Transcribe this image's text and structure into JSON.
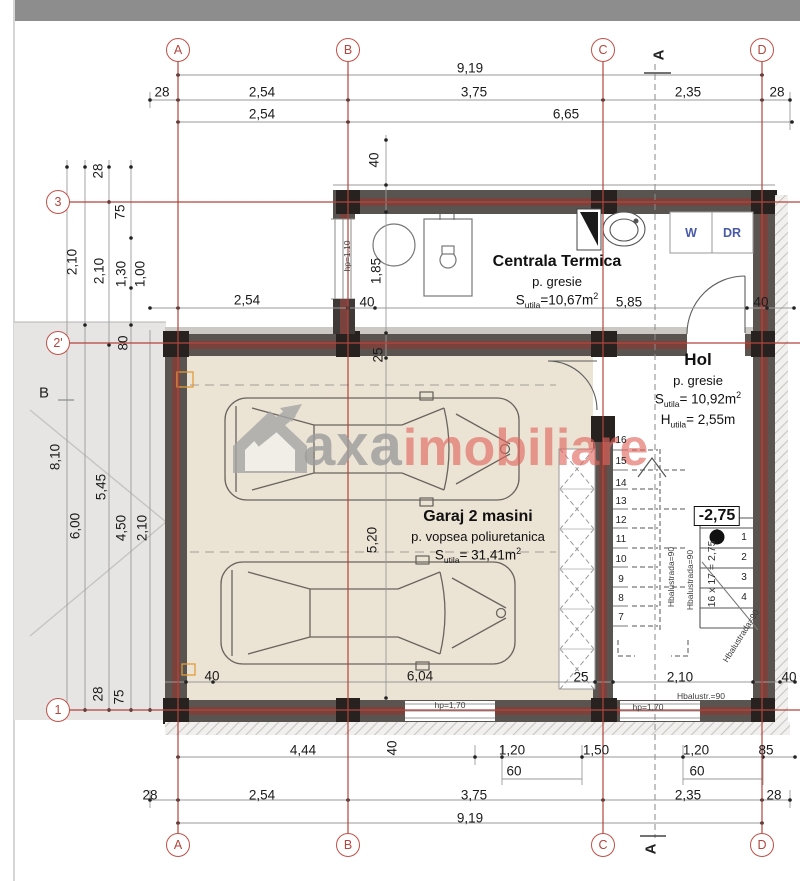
{
  "colors": {
    "axis_red": "#b2453c",
    "wall_gray": "#595450",
    "wall_core_red": "#7a423c",
    "column_black": "#272220",
    "garage_floor_beige": "#ebe3d4",
    "neighbor_gray": "#e6e5e4",
    "watermark_gray": "#9c9c9c",
    "watermark_red": "#e2645c",
    "wdr_blue": "#4a5aa8",
    "marker_orange": "#e09a3a"
  },
  "watermark": {
    "word1": "axa",
    "word2": "imobiliare"
  },
  "rooms": {
    "centrala": {
      "name": "Centrala Termica",
      "finish": "p. gresie",
      "area_label": "S",
      "area_sub": "utila",
      "area_val": "=10,67m",
      "area_sup": "2"
    },
    "hol": {
      "name": "Hol",
      "finish": "p. gresie",
      "area_label": "S",
      "area_sub": "utila",
      "area_val": "= 10,92m",
      "area_sup": "2",
      "height_label": "H",
      "height_sub": "utila",
      "height_val": "= 2,55m"
    },
    "garaj": {
      "name": "Garaj 2 masini",
      "finish": "p. vopsea poliuretanica",
      "area_label": "S",
      "area_sub": "utila",
      "area_val": "= 31,41m",
      "area_sup": "2"
    }
  },
  "labels": [
    {
      "t": "9,19",
      "x": 470,
      "y": 68
    },
    {
      "t": "28",
      "x": 162,
      "y": 92
    },
    {
      "t": "2,54",
      "x": 262,
      "y": 92
    },
    {
      "t": "3,75",
      "x": 474,
      "y": 92
    },
    {
      "t": "2,35",
      "x": 688,
      "y": 92
    },
    {
      "t": "28",
      "x": 777,
      "y": 92
    },
    {
      "t": "2,54",
      "x": 262,
      "y": 114
    },
    {
      "t": "6,65",
      "x": 566,
      "y": 114
    },
    {
      "t": "40",
      "x": 374,
      "y": 160,
      "r": -90
    },
    {
      "t": "28",
      "x": 98,
      "y": 171,
      "r": -90
    },
    {
      "t": "75",
      "x": 120,
      "y": 212,
      "r": -90
    },
    {
      "t": "2,10",
      "x": 72,
      "y": 262,
      "r": -90
    },
    {
      "t": "2,10",
      "x": 99,
      "y": 271,
      "r": -90
    },
    {
      "t": "1,30",
      "x": 121,
      "y": 274,
      "r": -90
    },
    {
      "t": "1,00",
      "x": 140,
      "y": 274,
      "r": -90
    },
    {
      "t": "80",
      "x": 123,
      "y": 343,
      "r": -90
    },
    {
      "t": "2,54",
      "x": 247,
      "y": 300
    },
    {
      "t": "40",
      "x": 367,
      "y": 302
    },
    {
      "t": "1,85",
      "x": 376,
      "y": 271,
      "r": -90
    },
    {
      "t": "hp=1.10",
      "x": 347,
      "y": 256,
      "r": -90,
      "cls": "tiny"
    },
    {
      "t": "5,85",
      "x": 629,
      "y": 302
    },
    {
      "t": "40",
      "x": 761,
      "y": 302
    },
    {
      "t": "25",
      "x": 378,
      "y": 355,
      "r": -90
    },
    {
      "t": "8,10",
      "x": 55,
      "y": 457,
      "r": -90
    },
    {
      "t": "5,45",
      "x": 101,
      "y": 487,
      "r": -90
    },
    {
      "t": "6,00",
      "x": 75,
      "y": 526,
      "r": -90
    },
    {
      "t": "4,50",
      "x": 121,
      "y": 528,
      "r": -90
    },
    {
      "t": "2,10",
      "x": 142,
      "y": 528,
      "r": -90
    },
    {
      "t": "28",
      "x": 98,
      "y": 694,
      "r": -90
    },
    {
      "t": "75",
      "x": 119,
      "y": 697,
      "r": -90
    },
    {
      "t": "B",
      "x": 44,
      "y": 393,
      "cls": "big"
    },
    {
      "t": "5,20",
      "x": 372,
      "y": 540,
      "r": -90
    },
    {
      "t": "40",
      "x": 212,
      "y": 676
    },
    {
      "t": "6,04",
      "x": 420,
      "y": 676
    },
    {
      "t": "25",
      "x": 581,
      "y": 677
    },
    {
      "t": "2,10",
      "x": 680,
      "y": 677
    },
    {
      "t": "40",
      "x": 789,
      "y": 677
    },
    {
      "t": "4,44",
      "x": 303,
      "y": 750
    },
    {
      "t": "40",
      "x": 392,
      "y": 748,
      "r": -90
    },
    {
      "t": "1,20",
      "x": 512,
      "y": 750
    },
    {
      "t": "1,50",
      "x": 596,
      "y": 750
    },
    {
      "t": "1,20",
      "x": 696,
      "y": 750
    },
    {
      "t": "85",
      "x": 766,
      "y": 750
    },
    {
      "t": "60",
      "x": 514,
      "y": 771
    },
    {
      "t": "60",
      "x": 697,
      "y": 771
    },
    {
      "t": "28",
      "x": 150,
      "y": 795
    },
    {
      "t": "2,54",
      "x": 262,
      "y": 795
    },
    {
      "t": "3,75",
      "x": 474,
      "y": 795
    },
    {
      "t": "2,35",
      "x": 688,
      "y": 795
    },
    {
      "t": "28",
      "x": 774,
      "y": 795
    },
    {
      "t": "9,19",
      "x": 470,
      "y": 818
    },
    {
      "t": "hp=1,70",
      "x": 450,
      "y": 705,
      "cls": "tiny"
    },
    {
      "t": "hp=1,70",
      "x": 648,
      "y": 707,
      "cls": "tiny"
    },
    {
      "t": "Hbalustr.=90",
      "x": 701,
      "y": 696,
      "cls": "tiny"
    },
    {
      "t": "Hbalustrada=90",
      "x": 671,
      "y": 577,
      "r": -90,
      "cls": "tiny"
    },
    {
      "t": "Hbalustrada=90",
      "x": 690,
      "y": 580,
      "r": -90,
      "cls": "tiny"
    },
    {
      "t": "Hbalustrada=90",
      "x": 741,
      "y": 636,
      "r": -58,
      "cls": "tiny"
    },
    {
      "t": "16 x 17 = 2,75",
      "x": 712,
      "y": 574,
      "r": -90,
      "cls": "small"
    },
    {
      "t": "W",
      "x": 691,
      "y": 233,
      "cls": "wdr"
    },
    {
      "t": "DR",
      "x": 732,
      "y": 233,
      "cls": "wdr"
    },
    {
      "t": "16",
      "x": 621,
      "y": 441,
      "cls": "step"
    },
    {
      "t": "15",
      "x": 621,
      "y": 462,
      "cls": "step"
    },
    {
      "t": "14",
      "x": 621,
      "y": 484,
      "cls": "step"
    },
    {
      "t": "13",
      "x": 621,
      "y": 502,
      "cls": "step"
    },
    {
      "t": "12",
      "x": 621,
      "y": 521,
      "cls": "step"
    },
    {
      "t": "11",
      "x": 621,
      "y": 540,
      "cls": "step"
    },
    {
      "t": "10",
      "x": 621,
      "y": 560,
      "cls": "step"
    },
    {
      "t": "9",
      "x": 621,
      "y": 580,
      "cls": "step"
    },
    {
      "t": "8",
      "x": 621,
      "y": 599,
      "cls": "step"
    },
    {
      "t": "7",
      "x": 621,
      "y": 618,
      "cls": "step"
    },
    {
      "t": "1",
      "x": 744,
      "y": 538,
      "cls": "step"
    },
    {
      "t": "2",
      "x": 744,
      "y": 558,
      "cls": "step"
    },
    {
      "t": "3",
      "x": 744,
      "y": 578,
      "cls": "step"
    },
    {
      "t": "4",
      "x": 744,
      "y": 598,
      "cls": "step"
    },
    {
      "t": "-2,75",
      "x": 717,
      "y": 516,
      "cls": "level"
    },
    {
      "t": "A",
      "x": 178,
      "y": 50,
      "cls": "axis"
    },
    {
      "t": "B",
      "x": 348,
      "y": 50,
      "cls": "axis"
    },
    {
      "t": "C",
      "x": 603,
      "y": 50,
      "cls": "axis"
    },
    {
      "t": "D",
      "x": 762,
      "y": 50,
      "cls": "axis"
    },
    {
      "t": "A",
      "x": 178,
      "y": 845,
      "cls": "axis"
    },
    {
      "t": "B",
      "x": 348,
      "y": 845,
      "cls": "axis"
    },
    {
      "t": "C",
      "x": 603,
      "y": 845,
      "cls": "axis"
    },
    {
      "t": "D",
      "x": 762,
      "y": 845,
      "cls": "axis"
    },
    {
      "t": "3",
      "x": 58,
      "y": 202,
      "cls": "axis"
    },
    {
      "t": "2'",
      "x": 58,
      "y": 343,
      "cls": "axis"
    },
    {
      "t": "1",
      "x": 58,
      "y": 710,
      "cls": "axis"
    },
    {
      "t": "A",
      "x": 659,
      "y": 55,
      "r": -90,
      "cls": "sect"
    },
    {
      "t": "A",
      "x": 651,
      "y": 849,
      "r": -90,
      "cls": "sect"
    }
  ]
}
